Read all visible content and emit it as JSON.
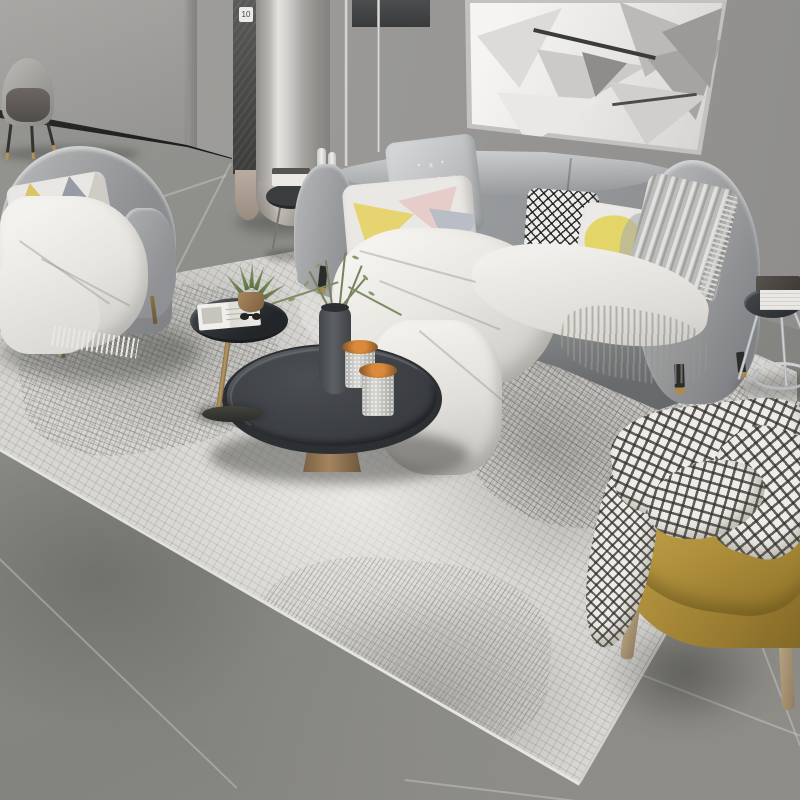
{
  "meta": {
    "type": "natural-image",
    "subject": "Modern gray living room product photo: fabric sofa set, round charcoal coffee table, abstract crosshatch area rug, mustard accent chair, abstract wall art",
    "dimensions": "800x800"
  },
  "labels": {
    "column_badge": "10",
    "pillow_monogram": [
      "* x *",
      "S U P H",
      "~ ~ ~"
    ]
  },
  "palette": {
    "wall": "#989794",
    "floor_tile": "#8a8a86",
    "baseboard": "#1f1f1d",
    "rug_base": "#d7d6d2",
    "rug_accent": "#6c6c68",
    "sofa_fabric": "#9a9c9e",
    "throw_white": "#efeeea",
    "pillow_yellow": "#e3d567",
    "pillow_pink": "#e6cdc9",
    "pillow_dark": "#3f4143",
    "coffee_table": "#3e4146",
    "bronze_base": "#9a7c58",
    "accent_chair": "#b2923f",
    "plant_green": "#75845c",
    "chrome": "#c7cbcd"
  },
  "objects": {
    "wall_art": "abstract geometric shard artwork in thin silver frame",
    "sofa": "three-seat gray fabric sofa with five decorative pillows and white fringed throw",
    "armchair": "gray fabric armchair with triangle-pattern cushion and white fringed throw",
    "coffee_table": "round charcoal tray-top coffee table on bronze cone base",
    "side_table_small": "black oval side table with open magazine, sunglasses and potted aloe",
    "console_table": "small round table behind sofa with stacked books",
    "end_table": "chrome-leg round end table with stacked books",
    "accent_chair": "mustard leather barrel chair with black-white gingham blanket",
    "rug": "light gray abstract crosshatch area rug",
    "column": "glossy round column with dark textured trim strip and numbered badge",
    "dining_chair": "gray shell dining chair in far corner",
    "floor": "large-format gray concrete-look tiles",
    "decor": "glitter jars with copper flower lids, sprig vase, white bottles"
  }
}
